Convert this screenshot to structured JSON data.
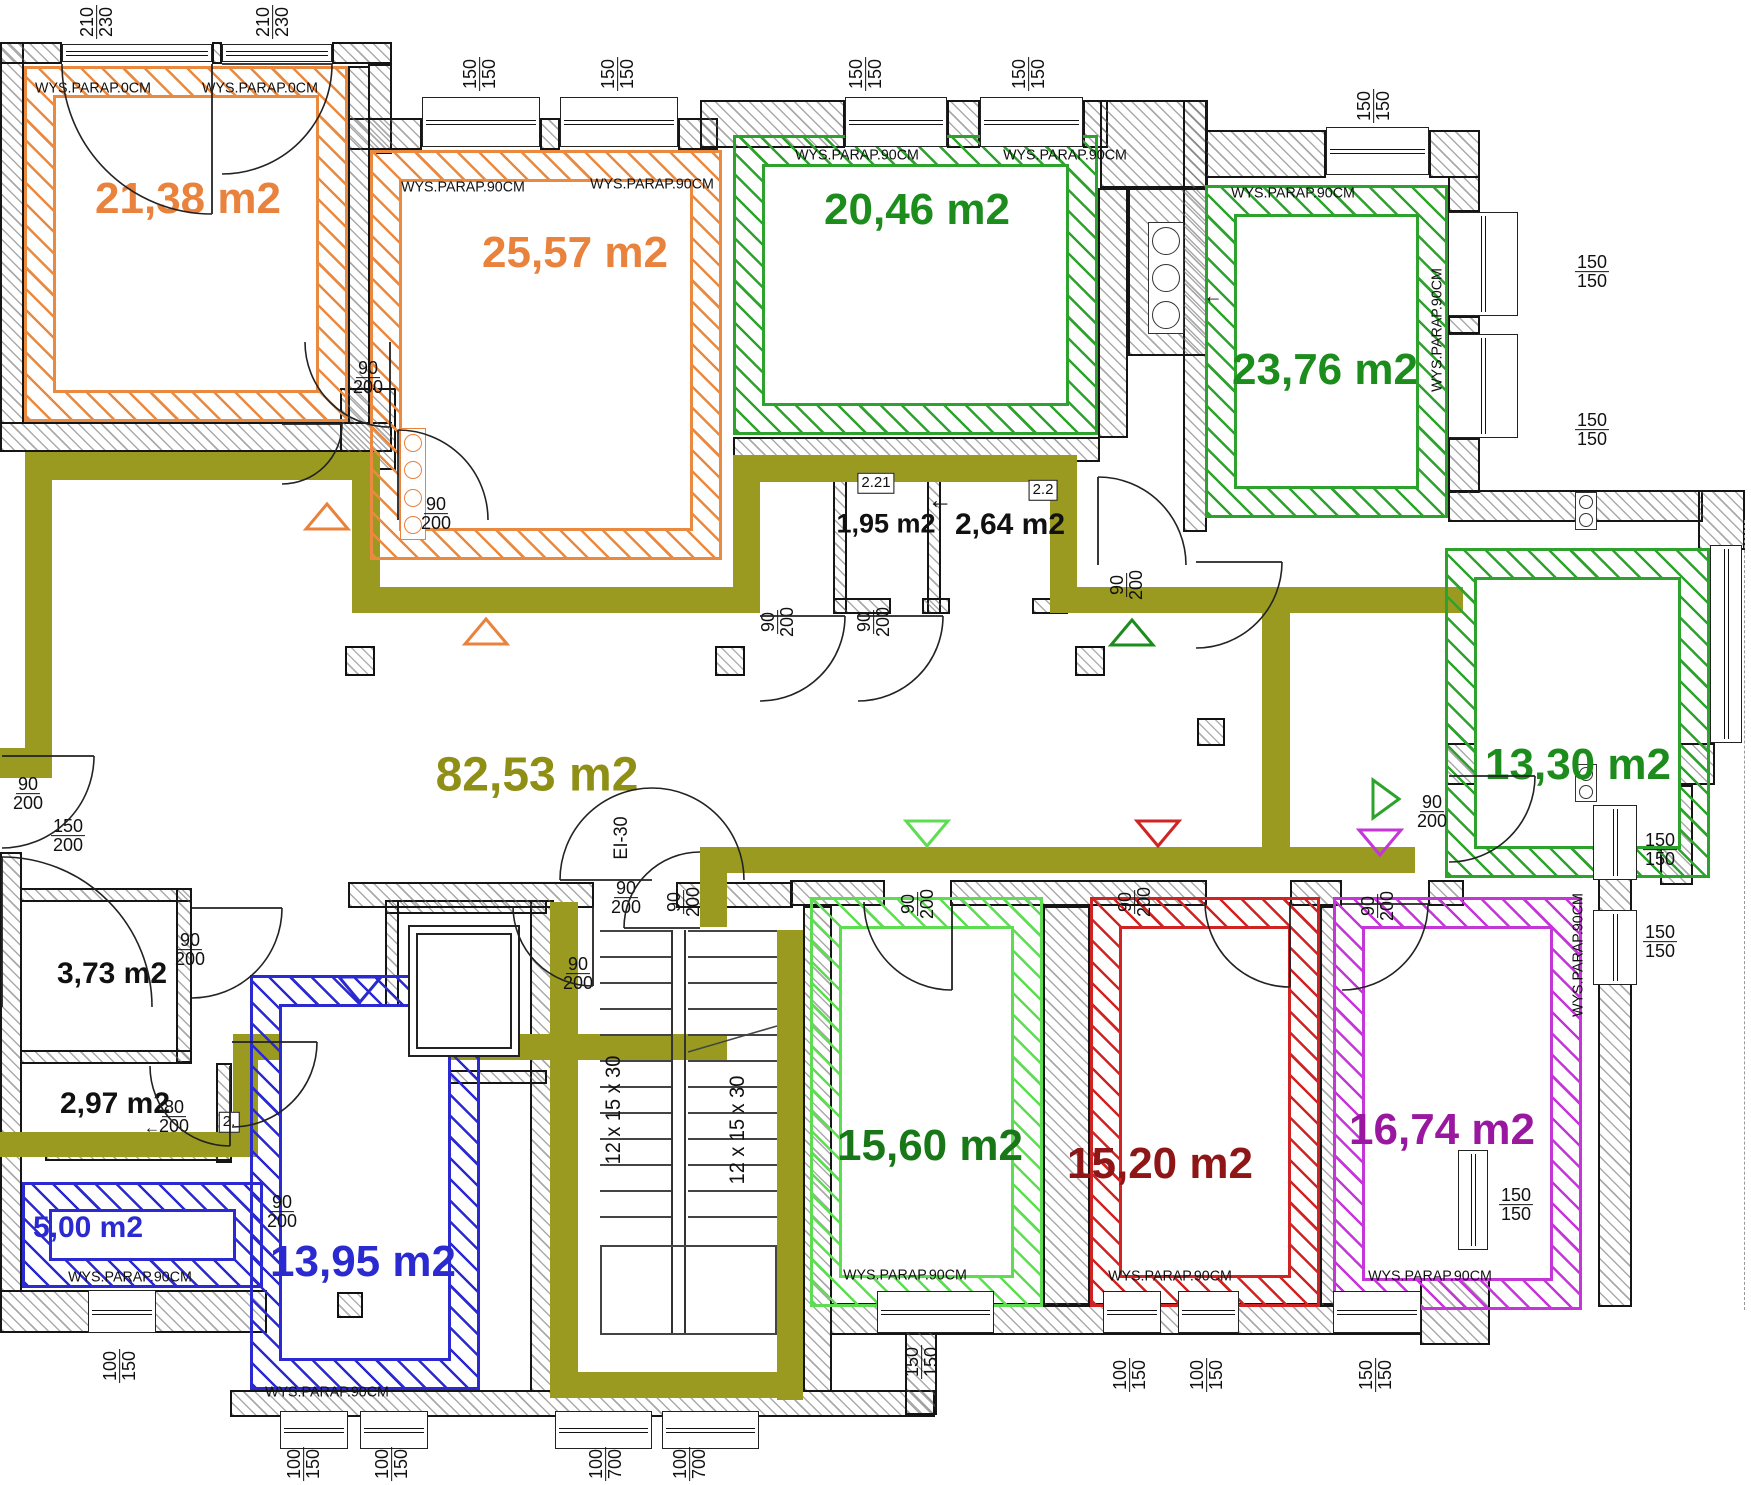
{
  "colors": {
    "orange": "#ea8a40",
    "green": "#2da32d",
    "lgreen": "#5fdd52",
    "red": "#d02424",
    "purple": "#c436d8",
    "blue": "#2a2ad0",
    "olive": "#9a9a20",
    "label_orange": "#e8823c",
    "label_green": "#1c8c1c",
    "label_dgreen": "#187818",
    "label_dred": "#8e1616",
    "label_dpurple": "#99189f",
    "label_blue": "#2a2ad0",
    "label_olive": "#8f8f16",
    "label_black": "#111111"
  },
  "room_bands": [
    [
      24,
      66,
      324,
      356,
      26,
      "orange"
    ],
    [
      370,
      150,
      352,
      410,
      26,
      "orange"
    ],
    [
      733,
      135,
      365,
      300,
      26,
      "green"
    ],
    [
      1205,
      185,
      243,
      333,
      26,
      "green"
    ],
    [
      1445,
      548,
      265,
      330,
      26,
      "green"
    ],
    [
      810,
      897,
      233,
      410,
      26,
      "lgreen"
    ],
    [
      1090,
      897,
      230,
      410,
      26,
      "red"
    ],
    [
      1333,
      897,
      249,
      413,
      26,
      "purple"
    ],
    [
      22,
      1182,
      241,
      106,
      24,
      "blue"
    ],
    [
      250,
      975,
      230,
      415,
      26,
      "blue"
    ]
  ],
  "room_labels": [
    {
      "t": "21,38 m2",
      "x": 188,
      "y": 199,
      "c": "label_orange",
      "s": 44
    },
    {
      "t": "25,57 m2",
      "x": 575,
      "y": 253,
      "c": "label_orange",
      "s": 44
    },
    {
      "t": "20,46 m2",
      "x": 917,
      "y": 210,
      "c": "label_green",
      "s": 44
    },
    {
      "t": "23,76 m2",
      "x": 1325,
      "y": 370,
      "c": "label_green",
      "s": 44
    },
    {
      "t": "13,30 m2",
      "x": 1578,
      "y": 765,
      "c": "label_green",
      "s": 44
    },
    {
      "t": "82,53 m2",
      "x": 537,
      "y": 775,
      "c": "label_olive",
      "s": 48
    },
    {
      "t": "1,95 m2",
      "x": 886,
      "y": 524,
      "c": "label_black",
      "s": 27
    },
    {
      "t": "2,64 m2",
      "x": 1010,
      "y": 525,
      "c": "label_black",
      "s": 30
    },
    {
      "t": "3,73 m2",
      "x": 112,
      "y": 974,
      "c": "label_black",
      "s": 30
    },
    {
      "t": "2,97 m2",
      "x": 115,
      "y": 1104,
      "c": "label_black",
      "s": 30
    },
    {
      "t": "5,00 m2",
      "x": 88,
      "y": 1228,
      "c": "label_blue",
      "s": 30
    },
    {
      "t": "13,95 m2",
      "x": 363,
      "y": 1262,
      "c": "label_blue",
      "s": 44
    },
    {
      "t": "15,60 m2",
      "x": 930,
      "y": 1146,
      "c": "label_dgreen",
      "s": 44
    },
    {
      "t": "15,20 m2",
      "x": 1160,
      "y": 1164,
      "c": "label_dred",
      "s": 44
    },
    {
      "t": "16,74 m2",
      "x": 1442,
      "y": 1130,
      "c": "label_dpurple",
      "s": 44
    }
  ],
  "walls": [
    [
      0,
      42,
      24,
      382
    ],
    [
      0,
      42,
      62,
      22
    ],
    [
      212,
      42,
      10,
      22
    ],
    [
      332,
      42,
      60,
      22
    ],
    [
      368,
      64,
      24,
      90
    ],
    [
      348,
      118,
      74,
      32
    ],
    [
      540,
      118,
      20,
      32
    ],
    [
      678,
      118,
      40,
      32
    ],
    [
      700,
      100,
      145,
      48
    ],
    [
      947,
      100,
      33,
      48
    ],
    [
      1083,
      100,
      25,
      48
    ],
    [
      1100,
      100,
      108,
      88
    ],
    [
      1205,
      130,
      121,
      48
    ],
    [
      1429,
      130,
      51,
      48
    ],
    [
      1448,
      176,
      32,
      36
    ],
    [
      1448,
      316,
      32,
      18
    ],
    [
      1448,
      438,
      32,
      55
    ],
    [
      1448,
      490,
      255,
      32
    ],
    [
      1698,
      490,
      47,
      60
    ],
    [
      1445,
      743,
      270,
      42
    ],
    [
      1660,
      785,
      33,
      100
    ],
    [
      1598,
      800,
      34,
      507
    ],
    [
      1420,
      1253,
      70,
      92
    ],
    [
      830,
      1303,
      592,
      32
    ],
    [
      0,
      1290,
      267,
      43
    ],
    [
      230,
      1390,
      705,
      27
    ],
    [
      0,
      852,
      22,
      440
    ],
    [
      905,
      1303,
      32,
      112
    ],
    [
      0,
      422,
      392,
      30
    ],
    [
      348,
      66,
      22,
      358
    ],
    [
      340,
      388,
      56,
      82
    ],
    [
      20,
      888,
      172,
      14
    ],
    [
      176,
      888,
      16,
      175
    ],
    [
      20,
      1050,
      172,
      14
    ],
    [
      216,
      1063,
      16,
      100
    ],
    [
      45,
      1147,
      187,
      14
    ],
    [
      530,
      900,
      24,
      492
    ],
    [
      385,
      900,
      162,
      14
    ],
    [
      385,
      900,
      14,
      184
    ],
    [
      385,
      1070,
      162,
      14
    ],
    [
      348,
      882,
      246,
      26
    ],
    [
      676,
      882,
      117,
      26
    ],
    [
      790,
      880,
      95,
      26
    ],
    [
      950,
      880,
      257,
      26
    ],
    [
      1290,
      880,
      52,
      26
    ],
    [
      1428,
      880,
      36,
      26
    ],
    [
      1043,
      906,
      47,
      401
    ],
    [
      1320,
      906,
      15,
      401
    ],
    [
      803,
      906,
      29,
      486
    ],
    [
      733,
      437,
      367,
      25
    ],
    [
      833,
      462,
      14,
      152
    ],
    [
      927,
      462,
      14,
      152
    ],
    [
      1050,
      462,
      18,
      152
    ],
    [
      833,
      598,
      58,
      16
    ],
    [
      922,
      598,
      28,
      16
    ],
    [
      1032,
      598,
      36,
      16
    ],
    [
      1183,
      100,
      24,
      432
    ],
    [
      1128,
      188,
      80,
      168
    ],
    [
      1098,
      188,
      30,
      250
    ]
  ],
  "olive_segments": [
    [
      25,
      452,
      353,
      28
    ],
    [
      25,
      452,
      27,
      298
    ],
    [
      0,
      748,
      52,
      30
    ],
    [
      352,
      452,
      28,
      161
    ],
    [
      352,
      587,
      381,
      26
    ],
    [
      733,
      455,
      27,
      158
    ],
    [
      733,
      455,
      344,
      27
    ],
    [
      1050,
      455,
      27,
      158
    ],
    [
      1050,
      587,
      413,
      26
    ],
    [
      1262,
      587,
      28,
      286
    ],
    [
      717,
      847,
      698,
      26
    ],
    [
      700,
      847,
      27,
      80
    ],
    [
      233,
      1034,
      494,
      26
    ],
    [
      233,
      1034,
      25,
      123
    ],
    [
      0,
      1132,
      258,
      25
    ],
    [
      550,
      902,
      28,
      496
    ],
    [
      777,
      930,
      26,
      470
    ],
    [
      550,
      1372,
      253,
      26
    ]
  ],
  "windows": [
    [
      62,
      44,
      150,
      18,
      "h"
    ],
    [
      222,
      44,
      110,
      18,
      "h"
    ],
    [
      422,
      97,
      118,
      50,
      "h"
    ],
    [
      560,
      97,
      118,
      50,
      "h"
    ],
    [
      845,
      97,
      102,
      50,
      "h"
    ],
    [
      980,
      97,
      103,
      50,
      "h"
    ],
    [
      1326,
      127,
      103,
      48,
      "h"
    ],
    [
      1448,
      212,
      70,
      104,
      "v"
    ],
    [
      1448,
      334,
      70,
      104,
      "v"
    ],
    [
      1710,
      545,
      32,
      198,
      "v"
    ],
    [
      1593,
      805,
      44,
      75,
      "v"
    ],
    [
      1593,
      910,
      44,
      75,
      "v"
    ],
    [
      1458,
      1150,
      30,
      100,
      "v"
    ],
    [
      88,
      1290,
      68,
      43,
      "h"
    ],
    [
      280,
      1411,
      68,
      38,
      "h"
    ],
    [
      360,
      1411,
      68,
      38,
      "h"
    ],
    [
      555,
      1411,
      97,
      38,
      "h"
    ],
    [
      662,
      1411,
      97,
      38,
      "h"
    ],
    [
      877,
      1291,
      117,
      42,
      "h"
    ],
    [
      1103,
      1291,
      58,
      42,
      "h"
    ],
    [
      1178,
      1291,
      61,
      42,
      "h"
    ],
    [
      1333,
      1291,
      88,
      42,
      "h"
    ]
  ],
  "dims": [
    {
      "a": "210",
      "b": "230",
      "x": 97,
      "y": 22,
      "r": true
    },
    {
      "a": "210",
      "b": "230",
      "x": 273,
      "y": 22,
      "r": true
    },
    {
      "a": "150",
      "b": "150",
      "x": 480,
      "y": 74,
      "r": true
    },
    {
      "a": "150",
      "b": "150",
      "x": 618,
      "y": 74,
      "r": true
    },
    {
      "a": "150",
      "b": "150",
      "x": 866,
      "y": 74,
      "r": true
    },
    {
      "a": "150",
      "b": "150",
      "x": 1029,
      "y": 74,
      "r": true
    },
    {
      "a": "150",
      "b": "150",
      "x": 1374,
      "y": 106,
      "r": true
    },
    {
      "a": "150",
      "b": "150",
      "x": 1592,
      "y": 272,
      "r": false
    },
    {
      "a": "150",
      "b": "150",
      "x": 1592,
      "y": 430,
      "r": false
    },
    {
      "a": "150",
      "b": "150",
      "x": 1660,
      "y": 850,
      "r": false
    },
    {
      "a": "150",
      "b": "150",
      "x": 1660,
      "y": 942,
      "r": false
    },
    {
      "a": "150",
      "b": "150",
      "x": 1516,
      "y": 1205,
      "r": false
    },
    {
      "a": "90",
      "b": "200",
      "x": 368,
      "y": 378,
      "r": false
    },
    {
      "a": "90",
      "b": "200",
      "x": 436,
      "y": 514,
      "r": false
    },
    {
      "a": "90",
      "b": "200",
      "x": 778,
      "y": 622,
      "r": true
    },
    {
      "a": "90",
      "b": "200",
      "x": 874,
      "y": 622,
      "r": true
    },
    {
      "a": "90",
      "b": "200",
      "x": 1127,
      "y": 585,
      "r": true
    },
    {
      "a": "90",
      "b": "200",
      "x": 1432,
      "y": 812,
      "r": false
    },
    {
      "a": "90",
      "b": "200",
      "x": 28,
      "y": 794,
      "r": false
    },
    {
      "a": "150",
      "b": "200",
      "x": 68,
      "y": 836,
      "r": false
    },
    {
      "a": "90",
      "b": "200",
      "x": 190,
      "y": 950,
      "r": false
    },
    {
      "a": "80",
      "b": "200",
      "x": 174,
      "y": 1117,
      "r": false
    },
    {
      "a": "90",
      "b": "200",
      "x": 578,
      "y": 974,
      "r": false
    },
    {
      "a": "90",
      "b": "200",
      "x": 684,
      "y": 902,
      "r": true
    },
    {
      "a": "90",
      "b": "200",
      "x": 626,
      "y": 898,
      "r": false
    },
    {
      "a": "90",
      "b": "200",
      "x": 918,
      "y": 904,
      "r": true
    },
    {
      "a": "90",
      "b": "200",
      "x": 1135,
      "y": 902,
      "r": true
    },
    {
      "a": "90",
      "b": "200",
      "x": 1378,
      "y": 906,
      "r": true
    },
    {
      "a": "90",
      "b": "200",
      "x": 282,
      "y": 1212,
      "r": false
    },
    {
      "a": "100",
      "b": "150",
      "x": 120,
      "y": 1366,
      "r": true
    },
    {
      "a": "100",
      "b": "150",
      "x": 304,
      "y": 1464,
      "r": true
    },
    {
      "a": "100",
      "b": "150",
      "x": 392,
      "y": 1464,
      "r": true
    },
    {
      "a": "100",
      "b": "700",
      "x": 606,
      "y": 1464,
      "r": true
    },
    {
      "a": "100",
      "b": "700",
      "x": 690,
      "y": 1464,
      "r": true
    },
    {
      "a": "150",
      "b": "150",
      "x": 922,
      "y": 1362,
      "r": true
    },
    {
      "a": "100",
      "b": "150",
      "x": 1130,
      "y": 1375,
      "r": true
    },
    {
      "a": "100",
      "b": "150",
      "x": 1207,
      "y": 1375,
      "r": true
    },
    {
      "a": "150",
      "b": "150",
      "x": 1376,
      "y": 1375,
      "r": true
    }
  ],
  "texts": [
    {
      "t": "WYS.PARAP.0CM",
      "x": 93,
      "y": 88,
      "r": false,
      "s": 15
    },
    {
      "t": "WYS.PARAP.0CM",
      "x": 260,
      "y": 88,
      "r": false,
      "s": 15
    },
    {
      "t": "WYS.PARAP.90CM",
      "x": 463,
      "y": 187,
      "r": false,
      "s": 15
    },
    {
      "t": "WYS.PARAP.90CM",
      "x": 652,
      "y": 184,
      "r": false,
      "s": 15
    },
    {
      "t": "WYS.PARAP.90CM",
      "x": 857,
      "y": 155,
      "r": false,
      "s": 15
    },
    {
      "t": "WYS.PARAP.90CM",
      "x": 1065,
      "y": 155,
      "r": false,
      "s": 15
    },
    {
      "t": "WYS.PARAP.90CM",
      "x": 1293,
      "y": 193,
      "r": false,
      "s": 15
    },
    {
      "t": "WYS.PARAP.90CM",
      "x": 1437,
      "y": 330,
      "r": true,
      "s": 15
    },
    {
      "t": "WYS.PARAP.90CM",
      "x": 905,
      "y": 1275,
      "r": false,
      "s": 15
    },
    {
      "t": "WYS.PARAP.90CM",
      "x": 1170,
      "y": 1276,
      "r": false,
      "s": 15
    },
    {
      "t": "WYS.PARAP.90CM",
      "x": 1430,
      "y": 1276,
      "r": false,
      "s": 15
    },
    {
      "t": "WYS.PARAP.90CM",
      "x": 1578,
      "y": 955,
      "r": true,
      "s": 15
    },
    {
      "t": "WYS.PARAP.90CM",
      "x": 130,
      "y": 1277,
      "r": false,
      "s": 15
    },
    {
      "t": "WYS.PARAP.90CM",
      "x": 327,
      "y": 1392,
      "r": false,
      "s": 15
    },
    {
      "t": "EI-30",
      "x": 622,
      "y": 838,
      "r": true,
      "s": 19
    },
    {
      "t": "12 x 15 x 30",
      "x": 614,
      "y": 1110,
      "r": true,
      "s": 21
    },
    {
      "t": "12 x 15 x 30",
      "x": 738,
      "y": 1130,
      "r": true,
      "s": 21
    },
    {
      "t": "←",
      "x": 940,
      "y": 500,
      "r": false,
      "s": 26
    },
    {
      "t": "←",
      "x": 1213,
      "y": 297,
      "r": false,
      "s": 20
    },
    {
      "t": "←",
      "x": 152,
      "y": 1128,
      "r": false,
      "s": 17
    }
  ],
  "tags": [
    {
      "t": "2.21",
      "x": 876,
      "y": 483
    },
    {
      "t": "2.2",
      "x": 1043,
      "y": 490
    },
    {
      "t": "2.",
      "x": 229,
      "y": 1122
    }
  ],
  "columns": [
    [
      345,
      646,
      30
    ],
    [
      715,
      646,
      30
    ],
    [
      1075,
      646,
      30
    ],
    [
      1197,
      718,
      28
    ],
    [
      337,
      1292,
      26
    ]
  ],
  "ducts": [
    {
      "x": 400,
      "y": 428,
      "w": 26,
      "h": 112,
      "n": 4,
      "c": "#e8823c"
    },
    {
      "x": 1148,
      "y": 222,
      "w": 36,
      "h": 112,
      "n": 3,
      "c": "#333333"
    },
    {
      "x": 1575,
      "y": 492,
      "w": 22,
      "h": 38,
      "n": 2,
      "c": "#333333"
    },
    {
      "x": 1575,
      "y": 764,
      "w": 22,
      "h": 38,
      "n": 2,
      "c": "#333333"
    }
  ],
  "stairs": {
    "flights": [
      [
        600,
        72
      ],
      [
        688,
        89
      ]
    ],
    "ytop": 930,
    "n": 12,
    "step": 26,
    "rails": [
      [
        671,
        930,
        2,
        405
      ],
      [
        684,
        930,
        2,
        405
      ]
    ],
    "landing": [
      600,
      1245,
      177,
      90
    ],
    "diagonal": [
      688,
      1052,
      777,
      1026
    ]
  },
  "elevator": {
    "cabs": [
      [
        408,
        925,
        112,
        132
      ],
      [
        416,
        933,
        96,
        116
      ]
    ]
  },
  "dashes": [
    [
      1744,
      520,
      790
    ]
  ],
  "triangles": [
    {
      "x": 327,
      "y": 517,
      "d": "up",
      "c": "#e8823c"
    },
    {
      "x": 486,
      "y": 632,
      "d": "up",
      "c": "#e8823c"
    },
    {
      "x": 1132,
      "y": 633,
      "d": "up",
      "c": "#1c8c1c"
    },
    {
      "x": 927,
      "y": 833,
      "d": "down",
      "c": "#5fdd52"
    },
    {
      "x": 1158,
      "y": 833,
      "d": "down",
      "c": "#d02424"
    },
    {
      "x": 1384,
      "y": 799,
      "d": "right",
      "c": "#2da32d"
    },
    {
      "x": 1380,
      "y": 842,
      "d": "down",
      "c": "#c436d8"
    },
    {
      "x": 360,
      "y": 989,
      "d": "down",
      "c": "#2a2ad0"
    }
  ],
  "doors": [
    {
      "hx": 212,
      "hy": 64,
      "r": 150,
      "a0": 90,
      "a1": 180
    },
    {
      "hx": 222,
      "hy": 64,
      "r": 110,
      "a0": 0,
      "a1": 90
    },
    {
      "hx": 390,
      "hy": 342,
      "r": 85,
      "a0": 90,
      "a1": 180
    },
    {
      "hx": 398,
      "hy": 520,
      "r": 90,
      "a0": 270,
      "a1": 360
    },
    {
      "hx": 282,
      "hy": 424,
      "r": 60,
      "a0": 0,
      "a1": 90
    },
    {
      "hx": 760,
      "hy": 616,
      "r": 85,
      "a0": 0,
      "a1": 90
    },
    {
      "hx": 858,
      "hy": 616,
      "r": 85,
      "a0": 0,
      "a1": 90
    },
    {
      "hx": 1196,
      "hy": 562,
      "r": 86,
      "a0": 0,
      "a1": 90
    },
    {
      "hx": 1098,
      "hy": 565,
      "r": 88,
      "a0": 270,
      "a1": 360
    },
    {
      "hx": 2,
      "hy": 756,
      "r": 92,
      "a0": 0,
      "a1": 90
    },
    {
      "hx": 2,
      "hy": 1007,
      "r": 150,
      "a0": 270,
      "a1": 360
    },
    {
      "hx": 192,
      "hy": 908,
      "r": 90,
      "a0": 0,
      "a1": 90
    },
    {
      "hx": 230,
      "hy": 1066,
      "r": 80,
      "a0": 90,
      "a1": 180
    },
    {
      "hx": 652,
      "hy": 880,
      "r": 92,
      "a0": 180,
      "a1": 360
    },
    {
      "hx": 700,
      "hy": 928,
      "r": 76,
      "a0": 180,
      "a1": 270
    },
    {
      "hx": 593,
      "hy": 906,
      "r": 80,
      "a0": 90,
      "a1": 180
    },
    {
      "hx": 952,
      "hy": 902,
      "r": 88,
      "a0": 90,
      "a1": 180
    },
    {
      "hx": 1290,
      "hy": 902,
      "r": 85,
      "a0": 90,
      "a1": 180
    },
    {
      "hx": 1342,
      "hy": 904,
      "r": 86,
      "a0": 0,
      "a1": 90
    },
    {
      "hx": 1449,
      "hy": 776,
      "r": 86,
      "a0": 0,
      "a1": 90
    },
    {
      "hx": 232,
      "hy": 1042,
      "r": 85,
      "a0": 0,
      "a1": 90
    }
  ]
}
